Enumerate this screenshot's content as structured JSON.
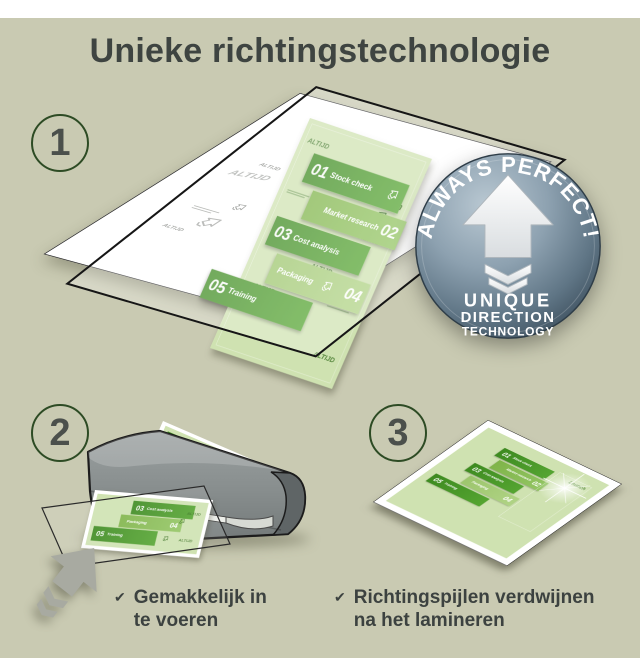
{
  "title": "Unieke richtingstechnologie",
  "steps": {
    "step1": "1",
    "step2": "2",
    "step3": "3"
  },
  "badge": {
    "arc_text": "ALWAYS PERFECT!",
    "line1": "UNIQUE",
    "line2": "DIRECTION",
    "line3": "TECHNOLOGY"
  },
  "doc": {
    "watermark": "ALTIJD",
    "launch": "Launch",
    "items": [
      {
        "num": "01",
        "label": "Stock check"
      },
      {
        "num": "02",
        "label": "Market research"
      },
      {
        "num": "03",
        "label": "Cost analysis"
      },
      {
        "num": "04",
        "label": "Packaging"
      },
      {
        "num": "05",
        "label": "Training"
      }
    ]
  },
  "captions": {
    "check": "✔",
    "left_line1": "Gemakkelijk in",
    "left_line2": "te voeren",
    "right_line1": "Richtingspijlen verdwijnen",
    "right_line2": "na het lamineren"
  },
  "colors": {
    "background": "#c9cab2",
    "title_text": "#3e4441",
    "step_ring": "#2d4b24",
    "step_number": "#4b504c",
    "tile_dark_green": "#4f9e2c",
    "tile_mid_green": "#8cbf58",
    "tile_light_green": "#a6cd77",
    "doc_background": "#cfe2b1",
    "badge_blue_gray": "#64798a",
    "laminator_gray": "#878d8d",
    "arrow_gray": "#a8aaa1"
  }
}
